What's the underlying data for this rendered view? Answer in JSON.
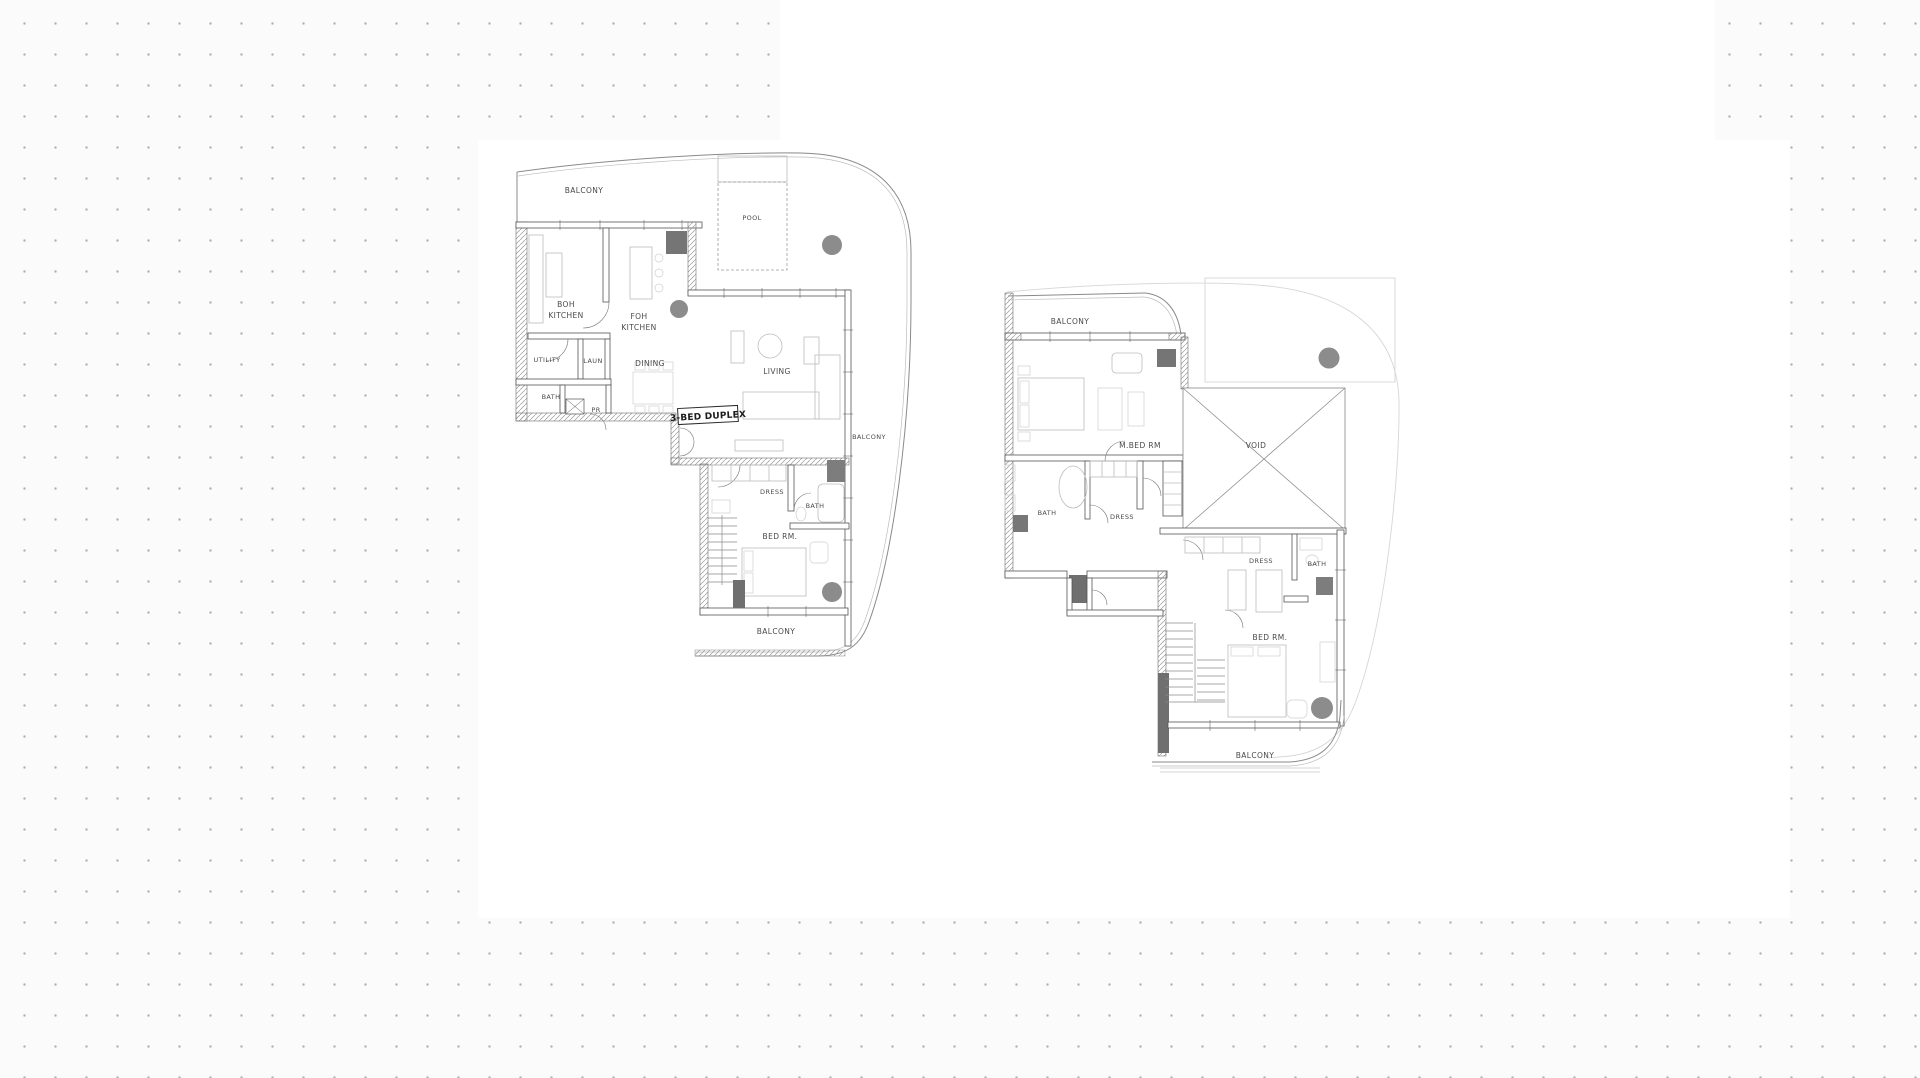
{
  "document": {
    "type": "architectural-floor-plan",
    "unit_tag": "3-BED DUPLEX"
  },
  "palette": {
    "sheet": "#ffffff",
    "dot_grid": "#aeaeae",
    "wall_line": "#555555",
    "outer_line": "#8a8a8a",
    "faint_line": "#d6d6d6",
    "furniture_line": "#bdbdbd",
    "column_fill": "#8c8c8c",
    "block_fill": "#707070",
    "label_text": "#4a4a4a"
  },
  "lower_level": {
    "balcony_top": "BALCONY",
    "pool": "POOL",
    "boh_kitchen": [
      "BOH",
      "KITCHEN"
    ],
    "foh_kitchen": [
      "FOH",
      "KITCHEN"
    ],
    "utility": "UTILITY",
    "laundry": "LAUN",
    "dining": "DINING",
    "bath": "BATH",
    "powder_room": "PR",
    "living": "LIVING",
    "balcony_right": "BALCONY",
    "dress": "DRESS",
    "bath2": "BATH",
    "bed_room": "BED RM.",
    "balcony_bottom": "BALCONY"
  },
  "upper_level": {
    "balcony_top": "BALCONY",
    "master_bed_room": "M.BED RM",
    "void": "VOID",
    "bath": "BATH",
    "dress": "DRESS",
    "dress2": "DRESS",
    "bath2": "BATH",
    "bed_room": "BED RM.",
    "balcony_bottom": "BALCONY"
  }
}
